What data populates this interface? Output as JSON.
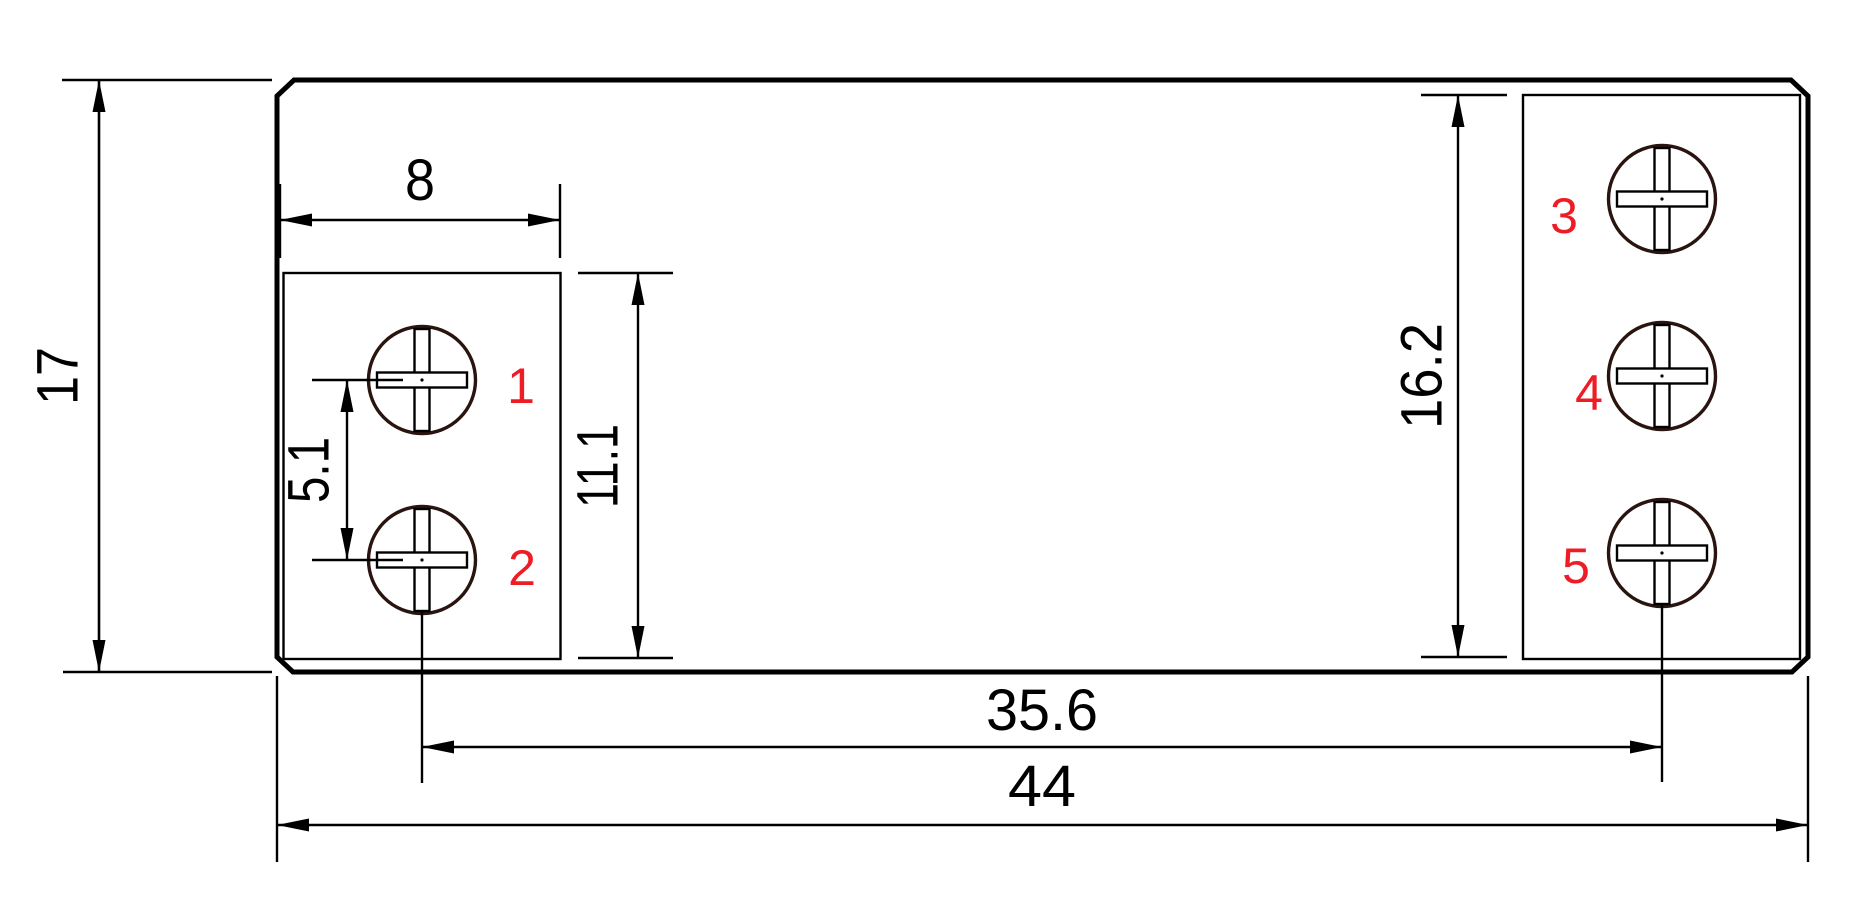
{
  "drawing": {
    "kind": "technical-dimension-drawing",
    "subject": "5-terminal screw terminal block footprint, top view"
  },
  "colors": {
    "line": "#000000",
    "screw_outline": "#2a1410",
    "terminal_label": "#ee1c25",
    "background": "#ffffff"
  },
  "dimensions": {
    "overall_height": "17",
    "left_block_width": "8",
    "left_pitch": "5.1",
    "left_block_height": "11.1",
    "right_block_height": "16.2",
    "screw_span": "35.6",
    "overall_width": "44"
  },
  "terminals": {
    "t1": "1",
    "t2": "2",
    "t3": "3",
    "t4": "4",
    "t5": "5"
  }
}
